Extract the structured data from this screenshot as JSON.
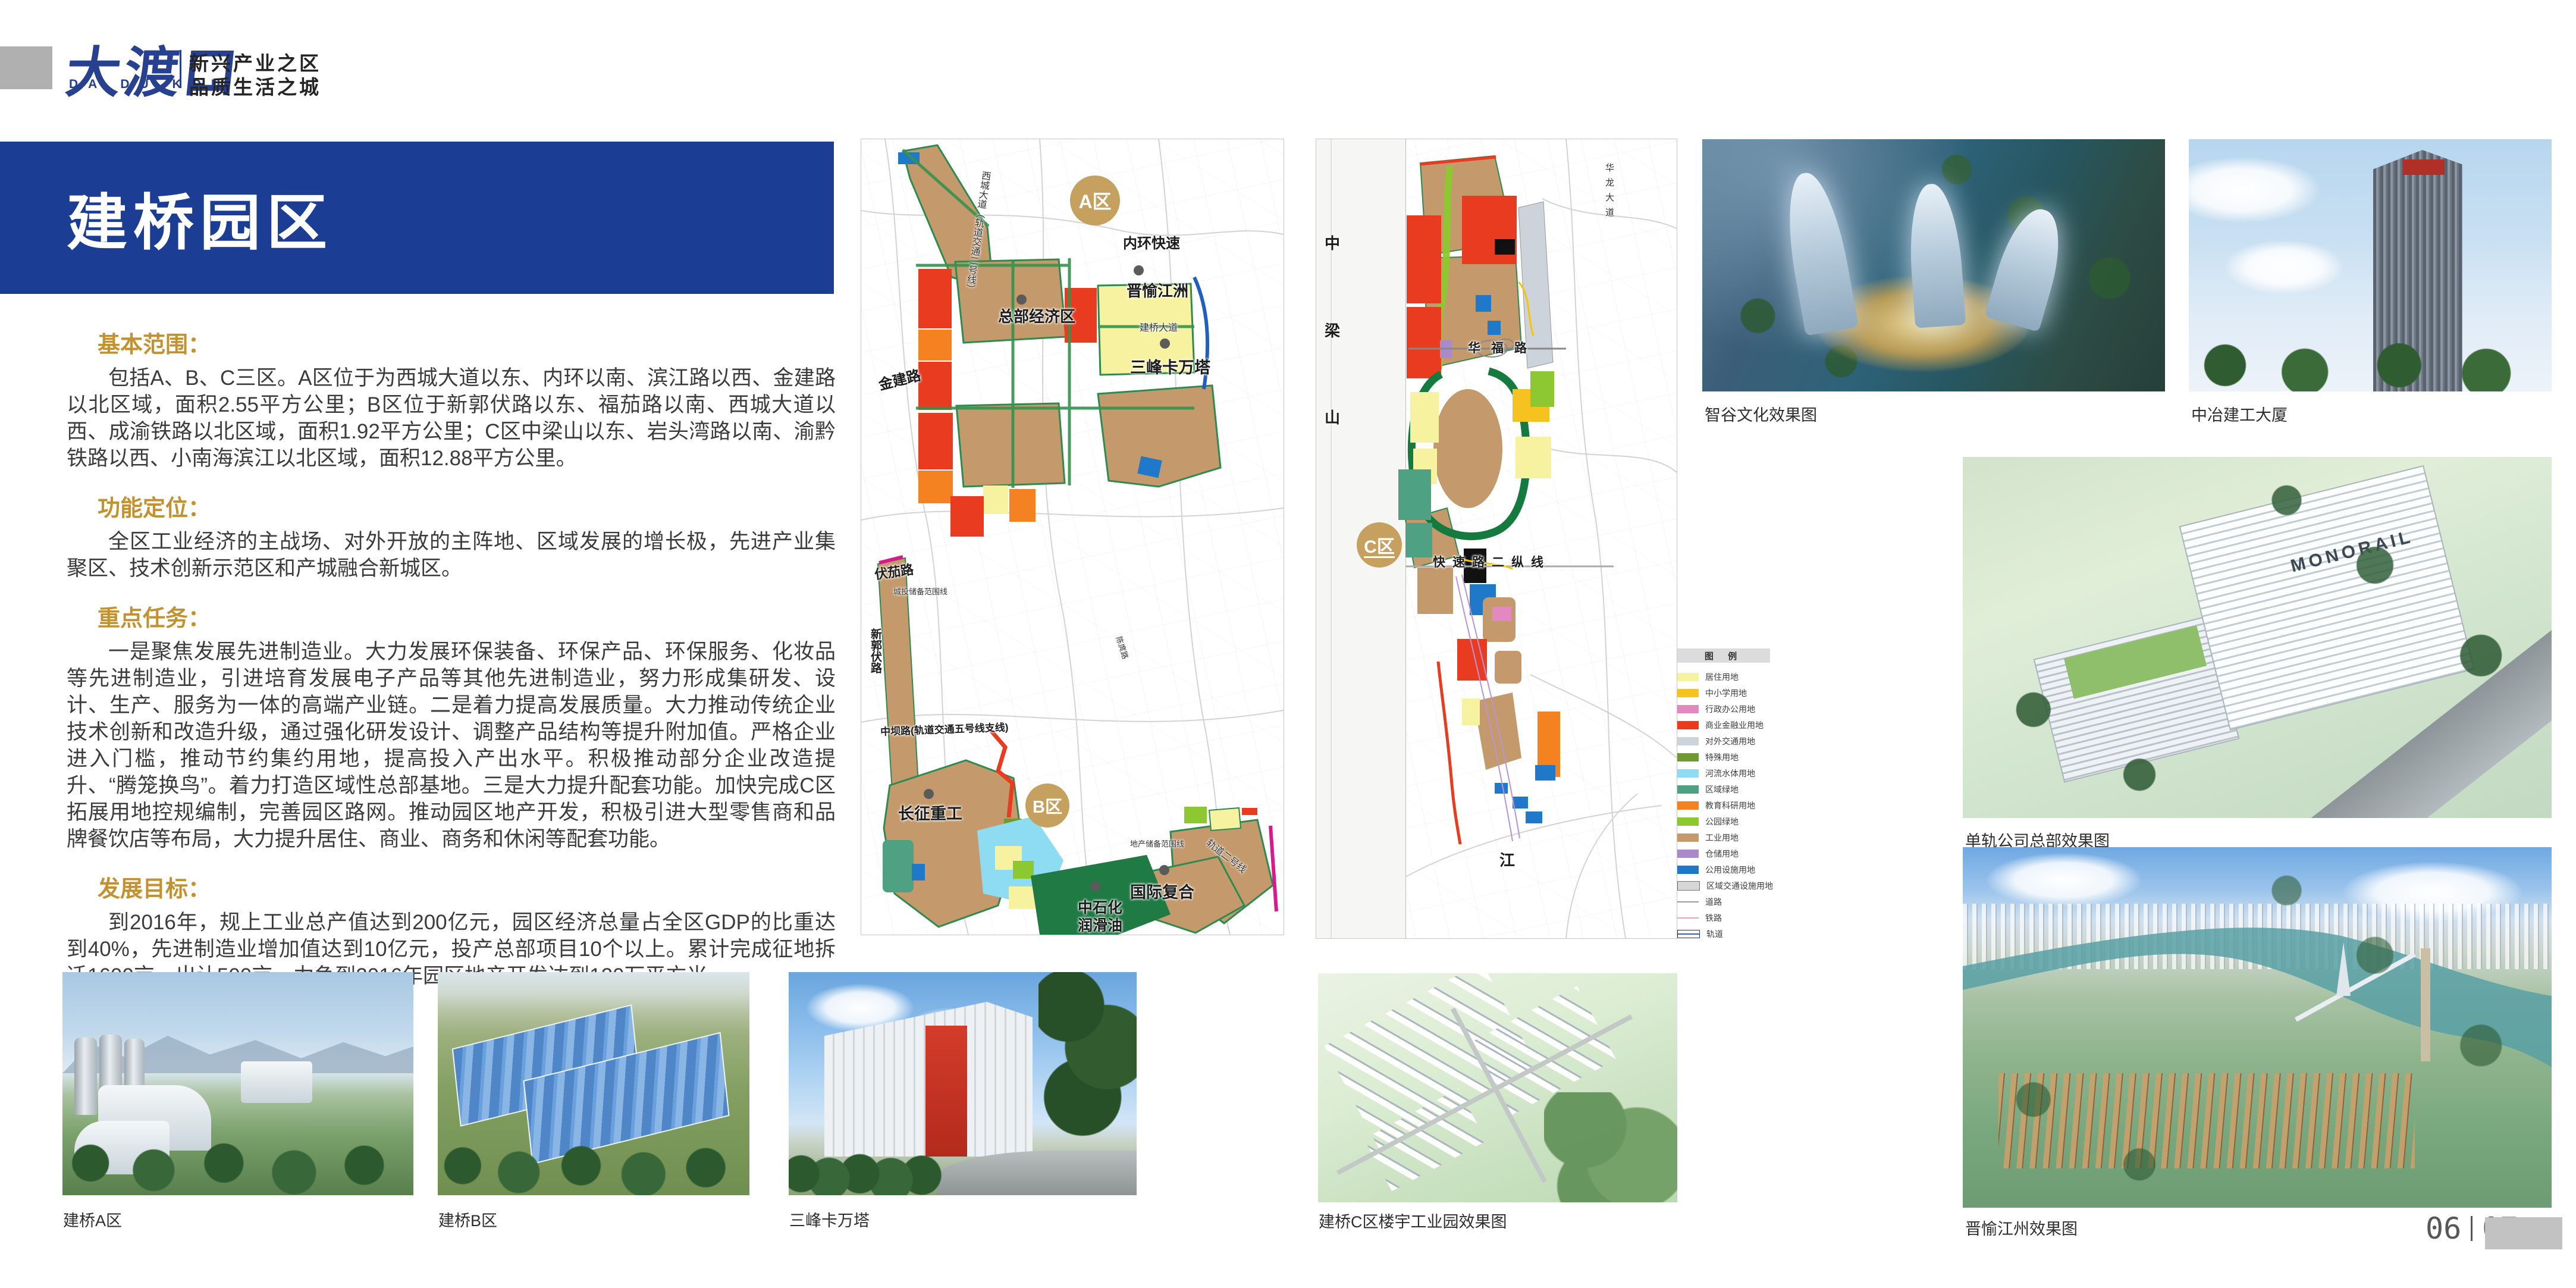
{
  "colors": {
    "banner": "#1c3d94",
    "brand": "#27408f",
    "gold": "#c3922e",
    "badge": "#c5a05e"
  },
  "brand": {
    "logo_cn": "大渡口",
    "logo_en": "DA DU KOU",
    "tagline1": "新兴产业之区",
    "tagline2": "品质生活之城"
  },
  "banner": {
    "title": "建桥园区"
  },
  "article": {
    "sections": [
      {
        "heading": "基本范围：",
        "body": "包括A、B、C三区。A区位于为西城大道以东、内环以南、滨江路以西、金建路以北区域，面积2.55平方公里；B区位于新郭伏路以东、福茄路以南、西城大道以西、成渝铁路以北区域，面积1.92平方公里；C区中梁山以东、岩头湾路以南、渝黔铁路以西、小南海滨江以北区域，面积12.88平方公里。"
      },
      {
        "heading": "功能定位：",
        "body": "全区工业经济的主战场、对外开放的主阵地、区域发展的增长极，先进产业集聚区、技术创新示范区和产城融合新城区。"
      },
      {
        "heading": "重点任务：",
        "body": "一是聚焦发展先进制造业。大力发展环保装备、环保产品、环保服务、化妆品等先进制造业，引进培育发展电子产品等其他先进制造业，努力形成集研发、设计、生产、服务为一体的高端产业链。二是着力提高发展质量。大力推动传统企业技术创新和改造升级，通过强化研发设计、调整产品结构等提升附加值。严格企业进入门槛，推动节约集约用地，提高投入产出水平。积极推动部分企业改造提升、“腾笼换鸟”。着力打造区域性总部基地。三是大力提升配套功能。加快完成C区拓展用地控规编制，完善园区路网。推动园区地产开发，积极引进大型零售商和品牌餐饮店等布局，大力提升居住、商业、商务和休闲等配套功能。"
      },
      {
        "heading": "发展目标：",
        "body": "到2016年，规上工业总产值达到200亿元，园区经济总量占全区GDP的比重达到40%，先进制造业增加值达到10亿元，投产总部项目10个以上。累计完成征地拆迁1600亩、出让500亩，力争到2016年园区地产开发达到120万平方米。"
      }
    ]
  },
  "maps": {
    "left": {
      "badge_a": "A区",
      "badge_b": "B区",
      "labels": {
        "neihuan": "内环快速",
        "jinyu": "晋愉江洲",
        "zongbu": "总部经济区",
        "sanfeng": "三峰卡万塔",
        "jianqiao_dadao": "建桥大道",
        "xicheng": "西城大道（轨道交通二号线）",
        "jinjianlu": "金建路",
        "fujialu": "伏茄路",
        "chengtou": "城投储备范围线",
        "xinguofulu": "新郭伏路",
        "zhongbalu": "中坝路(轨道交通五号线支线)",
        "changzheng": "长征重工",
        "dichan": "地产储备范围线",
        "guoji": "国际复合",
        "zhongshihua1": "中石化",
        "zhongshihua2": "润滑油",
        "guidao2": "轨道二号线",
        "chentuolu": "陈庹路"
      }
    },
    "right": {
      "badge_c": "C区",
      "labels": {
        "zhong": "中",
        "liang": "梁",
        "shan": "山",
        "hualong": "华龙大道",
        "huafulu": "华福路",
        "kuaisulu": "快速路二纵线",
        "jiang": "江"
      }
    }
  },
  "legend": {
    "title": "图 例",
    "items": [
      {
        "label": "居住用地",
        "color": "#f7f2a0",
        "type": "swatch"
      },
      {
        "label": "中小学用地",
        "color": "#f6c21f",
        "type": "swatch"
      },
      {
        "label": "行政办公用地",
        "color": "#e389c1",
        "type": "swatch"
      },
      {
        "label": "商业金融业用地",
        "color": "#e83b20",
        "type": "swatch"
      },
      {
        "label": "对外交通用地",
        "color": "#ccd3db",
        "type": "swatch"
      },
      {
        "label": "特殊用地",
        "color": "#6f9a31",
        "type": "swatch"
      },
      {
        "label": "河流水体用地",
        "color": "#8edcf2",
        "type": "swatch"
      },
      {
        "label": "区域绿地",
        "color": "#4fa183",
        "type": "swatch"
      },
      {
        "label": "教育科研用地",
        "color": "#f58220",
        "type": "swatch"
      },
      {
        "label": "公园绿地",
        "color": "#8dc832",
        "type": "swatch"
      },
      {
        "label": "工业用地",
        "color": "#c49a6c",
        "type": "swatch"
      },
      {
        "label": "仓储用地",
        "color": "#a98bc9",
        "type": "swatch"
      },
      {
        "label": "公用设施用地",
        "color": "#1f78c8",
        "type": "swatch"
      },
      {
        "label": "区域交通设施用地",
        "color": "#d6d6d6",
        "type": "swatch-border"
      },
      {
        "label": "道路",
        "color": "#9a9a9a",
        "type": "line"
      },
      {
        "label": "铁路",
        "color": "#e8a0c8",
        "type": "line"
      },
      {
        "label": "轨道",
        "color": "#3a5fb0",
        "type": "track"
      }
    ]
  },
  "photos": {
    "zhigu": {
      "caption": "智谷文化效果图"
    },
    "zhongye": {
      "caption": "中冶建工大厦"
    },
    "monorail": {
      "caption": "单轨公司总部效果图",
      "sign": "MONORAIL"
    },
    "jiangzhou": {
      "caption": "晋愉江州效果图"
    },
    "aqu": {
      "caption": "建桥A区"
    },
    "bqu": {
      "caption": "建桥B区"
    },
    "sanfengta": {
      "caption": "三峰卡万塔"
    },
    "cqu": {
      "caption": "建桥C区楼宇工业园效果图"
    }
  },
  "footer": {
    "page_left": "06",
    "page_right": "07"
  }
}
